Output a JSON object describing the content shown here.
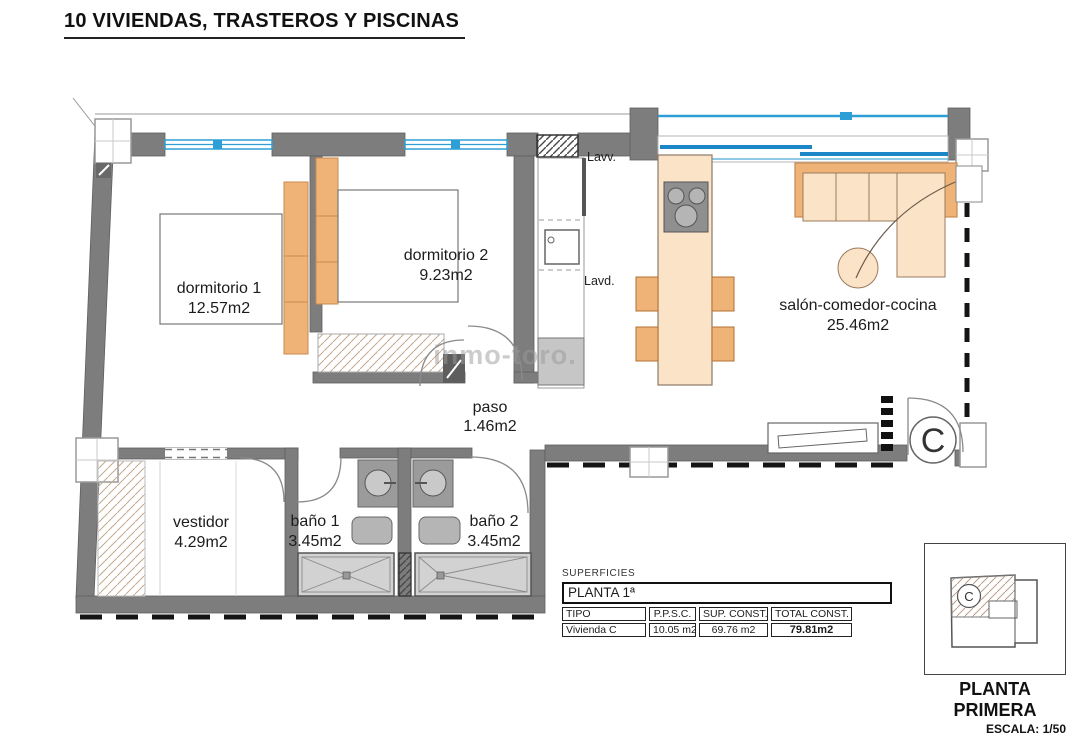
{
  "title": "10 VIVIENDAS, TRASTEROS Y PISCINAS",
  "watermark": "inmo-toro.",
  "rooms": {
    "dormitorio1": {
      "name": "dormitorio 1",
      "area": "12.57m2"
    },
    "dormitorio2": {
      "name": "dormitorio 2",
      "area": "9.23m2"
    },
    "salon": {
      "name": "salón-comedor-cocina",
      "area": "25.46m2"
    },
    "paso": {
      "name": "paso",
      "area": "1.46m2"
    },
    "vestidor": {
      "name": "vestidor",
      "area": "4.29m2"
    },
    "banyo1": {
      "name": "baño 1",
      "area": "3.45m2"
    },
    "banyo2": {
      "name": "baño 2",
      "area": "3.45m2"
    }
  },
  "annotations": {
    "lavv": "Lavv.",
    "lavd": "Lavd.",
    "unit_letter": "C"
  },
  "surfaces_table": {
    "label": "SUPERFICIES",
    "floor": "PLANTA 1ª",
    "headers": [
      "TIPO",
      "P.P.S.C.",
      "SUP. CONST.",
      "TOTAL CONST."
    ],
    "rows": [
      [
        "Vivienda C",
        "10.05 m2",
        "69.76 m2",
        "79.81m2"
      ]
    ]
  },
  "legend": {
    "title": "PLANTA PRIMERA",
    "scale": "ESCALA: 1/50",
    "unit_letter": "C"
  },
  "colors": {
    "wall": "#7d7d7d",
    "window_blue": "#1b87c9",
    "furniture_orange": "#f0b377",
    "furniture_peach": "#fbe3c8",
    "fixture_gray": "#c9c9c9",
    "dash_black": "#141414"
  }
}
